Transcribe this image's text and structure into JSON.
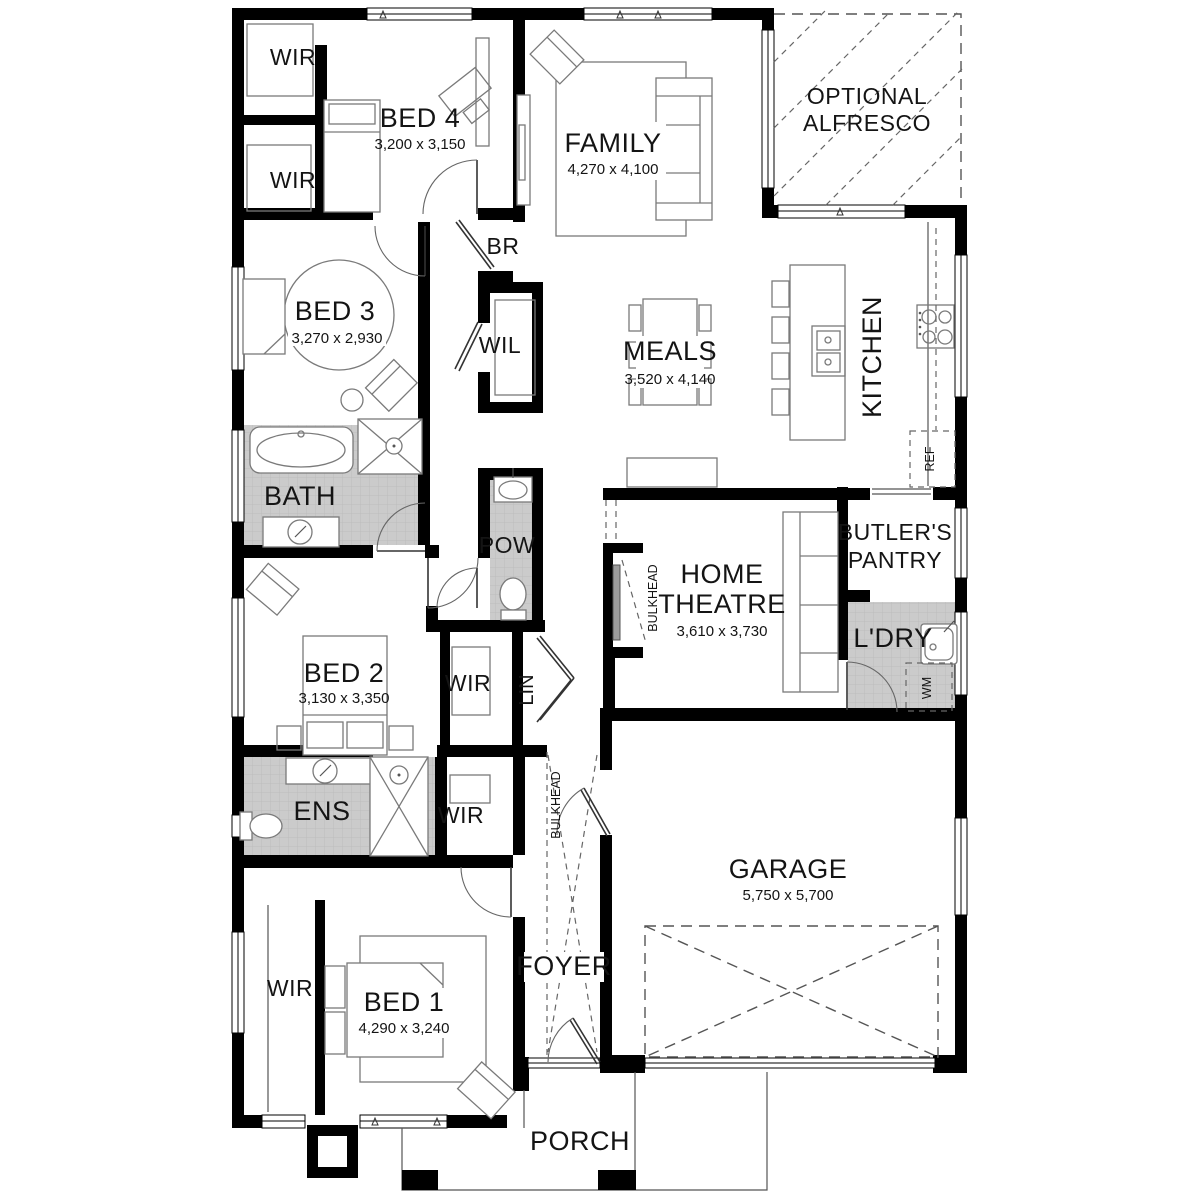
{
  "rooms": {
    "wir1": {
      "label": "WIR"
    },
    "bed4": {
      "label": "BED 4",
      "dims": "3,200 x 3,150"
    },
    "family": {
      "label": "FAMILY",
      "dims": "4,270 x 4,100"
    },
    "alfresco": {
      "line1": "OPTIONAL",
      "line2": "ALFRESCO"
    },
    "wir2": {
      "label": "WIR"
    },
    "br": {
      "label": "BR"
    },
    "bed3": {
      "label": "BED 3",
      "dims": "3,270 x 2,930"
    },
    "wil": {
      "label": "WIL"
    },
    "meals": {
      "label": "MEALS",
      "dims": "3,520 x 4,140"
    },
    "kitchen": {
      "label": "KITCHEN"
    },
    "ref": {
      "label": "REF"
    },
    "bath": {
      "label": "BATH"
    },
    "pow": {
      "label": "POW"
    },
    "butlers": {
      "line1": "BUTLER'S",
      "line2": "PANTRY"
    },
    "home_theatre": {
      "line1": "HOME",
      "line2": "THEATRE",
      "dims": "3,610 x 3,730"
    },
    "bulkhead_ht": {
      "label": "BULKHEAD"
    },
    "ldry": {
      "label": "L'DRY"
    },
    "wm": {
      "label": "WM"
    },
    "bed2": {
      "label": "BED 2",
      "dims": "3,130 x 3,350"
    },
    "wir3": {
      "label": "WIR"
    },
    "lin": {
      "label": "LIN"
    },
    "ens": {
      "label": "ENS"
    },
    "wir4": {
      "label": "WIR"
    },
    "bulkhead_foyer": {
      "label": "BULKHEAD"
    },
    "bed1": {
      "label": "BED 1",
      "dims": "4,290 x 3,240"
    },
    "wir5": {
      "label": "WIR"
    },
    "foyer": {
      "label": "FOYER"
    },
    "garage": {
      "label": "GARAGE",
      "dims": "5,750 x 5,700"
    },
    "porch": {
      "label": "PORCH"
    }
  },
  "colors": {
    "wall": "#000000",
    "tile": "#cbcbcb",
    "furniture_line": "#7a7a7a"
  }
}
